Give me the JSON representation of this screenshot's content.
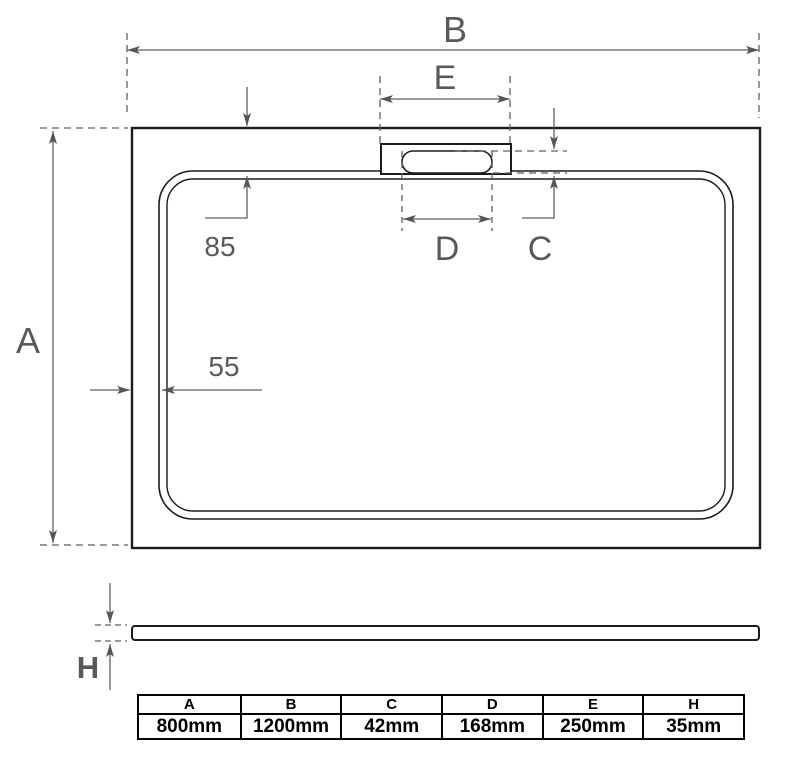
{
  "diagram": {
    "title": "shower-tray-technical-drawing",
    "labels": {
      "width": "B",
      "depth": "A",
      "waste_cutout_width": "E",
      "slot_length": "D",
      "slot_width": "C",
      "height": "H",
      "top_inset": "85",
      "side_inset": "55"
    },
    "colors": {
      "dimension_line": "#5f5f5f",
      "dimension_text": "#595959",
      "drawing_line": "#1b1b1b",
      "background": "#ffffff"
    }
  },
  "table": {
    "columns": [
      "A",
      "B",
      "C",
      "D",
      "E",
      "H"
    ],
    "values": [
      "800mm",
      "1200mm",
      "42mm",
      "168mm",
      "250mm",
      "35mm"
    ]
  }
}
